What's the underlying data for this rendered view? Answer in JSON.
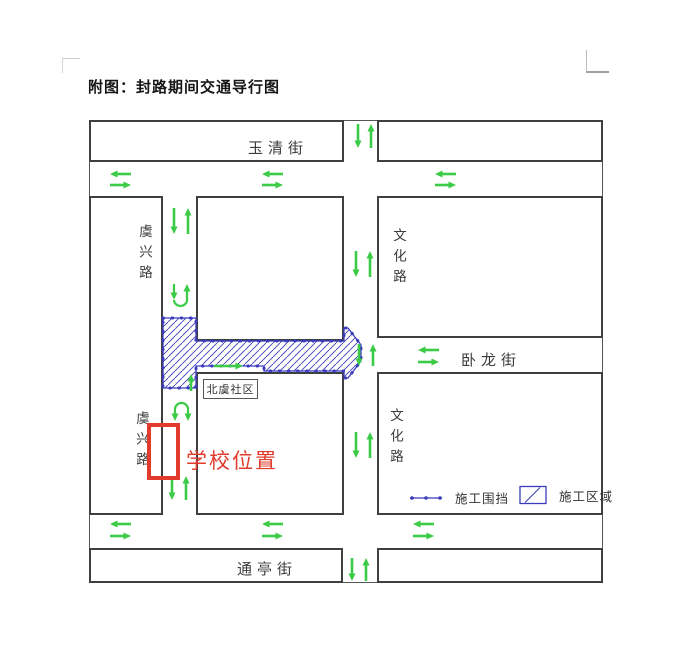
{
  "page": {
    "title": "附图：封路期间交通导行图"
  },
  "colors": {
    "arrow_green": "#3ccb46",
    "construction_blue": "#3b3bbe",
    "school_red": "#e23b2c",
    "block_border": "#3f3f3f"
  },
  "labels": {
    "street_yuqing": "玉清街",
    "street_wolong": "卧龙街",
    "street_tongting": "通亭街",
    "street_yuxing_upper": "虞兴路",
    "street_yuxing_lower": "虞兴路",
    "street_wenhua_upper": "文化路",
    "street_wenhua_lower": "文化路",
    "community": "北虞社区",
    "school": "学校位置",
    "legend_fence": "施工围挡",
    "legend_area": "施工区域"
  },
  "figure": {
    "map": {
      "x": 89,
      "y": 120,
      "w": 514,
      "h": 463
    },
    "blocks": [
      {
        "x": 89,
        "y": 120,
        "w": 255,
        "h": 42
      },
      {
        "x": 377,
        "y": 120,
        "w": 226,
        "h": 42
      },
      {
        "x": 89,
        "y": 196,
        "w": 74,
        "h": 319
      },
      {
        "x": 196,
        "y": 196,
        "w": 148,
        "h": 145
      },
      {
        "x": 377,
        "y": 196,
        "w": 226,
        "h": 142
      },
      {
        "x": 196,
        "y": 372,
        "w": 148,
        "h": 143
      },
      {
        "x": 377,
        "y": 372,
        "w": 226,
        "h": 143
      },
      {
        "x": 89,
        "y": 548,
        "w": 254,
        "h": 35
      },
      {
        "x": 377,
        "y": 548,
        "w": 226,
        "h": 35
      }
    ],
    "construction_path": "M163 318 L196 318 L196 341 L344 341 L344 328 L348 328 L361 345 L361 361 L348 378 L344 378 L344 371 L264 371 L264 366 L196 366 L196 388 L163 388 Z",
    "arrows": [
      {
        "dir": "down",
        "x": 358,
        "y1": 124,
        "y2": 148
      },
      {
        "dir": "up",
        "x": 371,
        "y1": 124,
        "y2": 148
      },
      {
        "dir": "down",
        "x": 174,
        "y1": 208,
        "y2": 234
      },
      {
        "dir": "up",
        "x": 188,
        "y1": 208,
        "y2": 234
      },
      {
        "dir": "down",
        "x": 356,
        "y1": 251,
        "y2": 277
      },
      {
        "dir": "up",
        "x": 370,
        "y1": 251,
        "y2": 277
      },
      {
        "dir": "down",
        "x": 359,
        "y1": 344,
        "y2": 366
      },
      {
        "dir": "up",
        "x": 373,
        "y1": 344,
        "y2": 366
      },
      {
        "dir": "down",
        "x": 356,
        "y1": 432,
        "y2": 458
      },
      {
        "dir": "up",
        "x": 370,
        "y1": 432,
        "y2": 458
      },
      {
        "dir": "down",
        "x": 172,
        "y1": 476,
        "y2": 500
      },
      {
        "dir": "up",
        "x": 186,
        "y1": 476,
        "y2": 500
      },
      {
        "dir": "down",
        "x": 352,
        "y1": 558,
        "y2": 581
      },
      {
        "dir": "up",
        "x": 366,
        "y1": 558,
        "y2": 581
      },
      {
        "dir": "left",
        "y": 174,
        "x1": 110,
        "x2": 131
      },
      {
        "dir": "right",
        "y": 185,
        "x1": 110,
        "x2": 131
      },
      {
        "dir": "left",
        "y": 174,
        "x1": 262,
        "x2": 283
      },
      {
        "dir": "right",
        "y": 185,
        "x1": 262,
        "x2": 283
      },
      {
        "dir": "left",
        "y": 174,
        "x1": 435,
        "x2": 456
      },
      {
        "dir": "right",
        "y": 185,
        "x1": 435,
        "x2": 456
      },
      {
        "dir": "left",
        "y": 524,
        "x1": 110,
        "x2": 131
      },
      {
        "dir": "right",
        "y": 536,
        "x1": 110,
        "x2": 131
      },
      {
        "dir": "left",
        "y": 524,
        "x1": 262,
        "x2": 283
      },
      {
        "dir": "right",
        "y": 536,
        "x1": 262,
        "x2": 283
      },
      {
        "dir": "left",
        "y": 524,
        "x1": 413,
        "x2": 434
      },
      {
        "dir": "right",
        "y": 536,
        "x1": 413,
        "x2": 434
      },
      {
        "dir": "left",
        "y": 350,
        "x1": 418,
        "x2": 439
      },
      {
        "dir": "right",
        "y": 362,
        "x1": 418,
        "x2": 439
      },
      {
        "dir": "right",
        "y": 366,
        "x1": 214,
        "x2": 243
      },
      {
        "dir": "up",
        "x": 191,
        "y1": 374,
        "y2": 391
      }
    ],
    "uturns": [
      {
        "d": "M174 300 A6.5 6 0 0 0 187 300",
        "legs": [
          {
            "dir": "down",
            "x": 174,
            "y1": 284,
            "y2": 300
          },
          {
            "dir": "up",
            "x": 187,
            "y1": 284,
            "y2": 300
          }
        ]
      },
      {
        "d": "M175 409 A6.5 6 0 0 1 188 409",
        "legs": [
          {
            "dir": "down",
            "x": 175,
            "y1": 409,
            "y2": 421
          },
          {
            "dir": "down",
            "x": 188,
            "y1": 409,
            "y2": 421
          }
        ]
      }
    ]
  }
}
